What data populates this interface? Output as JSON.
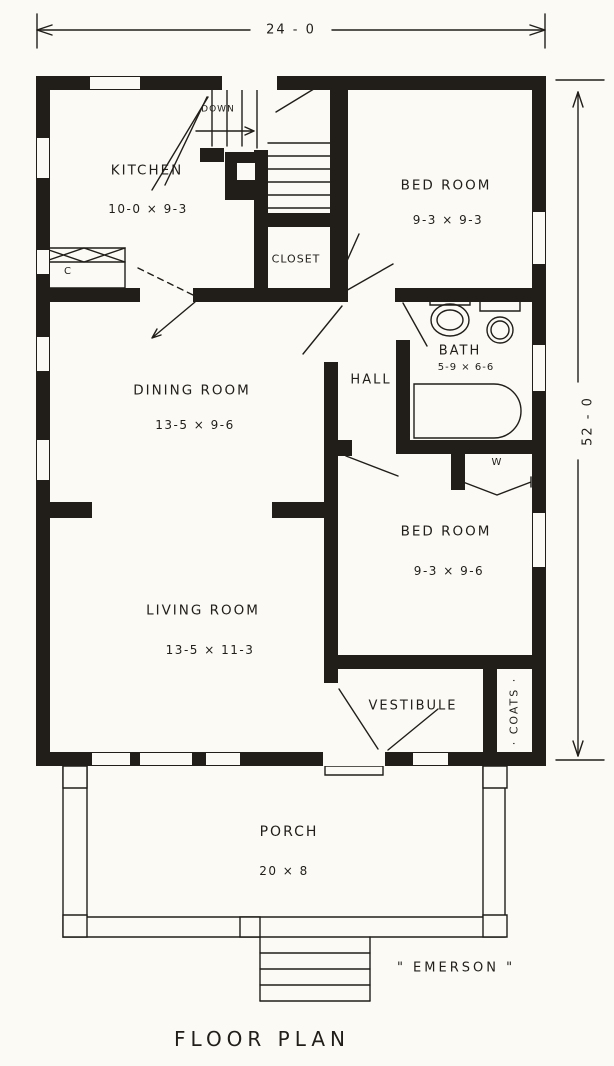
{
  "plan": {
    "caption": "FLOOR PLAN",
    "name": "\" EMERSON \"",
    "overall_width": "24 - 0",
    "overall_height": "52 - 0"
  },
  "rooms": {
    "kitchen": {
      "name": "KITCHEN",
      "size": "10-0 × 9-3"
    },
    "bedroom1": {
      "name": "BED ROOM",
      "size": "9-3 × 9-3"
    },
    "closet": {
      "name": "CLOSET"
    },
    "bath": {
      "name": "BATH",
      "size": "5-9 × 6-6"
    },
    "hall": {
      "name": "HALL"
    },
    "dining": {
      "name": "DINING ROOM",
      "size": "13-5 × 9-6"
    },
    "bedroom2": {
      "name": "BED ROOM",
      "size": "9-3 × 9-6"
    },
    "living": {
      "name": "LIVING ROOM",
      "size": "13-5 × 11-3"
    },
    "vestibule": {
      "name": "VESTIBULE"
    },
    "coats": {
      "name": "· COATS ·"
    },
    "porch": {
      "name": "PORCH",
      "size": "20 × 8"
    }
  },
  "annotations": {
    "stairs_down": "DOWN",
    "kitchen_case": "C",
    "wardrobe": "W"
  },
  "colors": {
    "ink": "#211e1a",
    "paper": "#fbfaf5"
  }
}
